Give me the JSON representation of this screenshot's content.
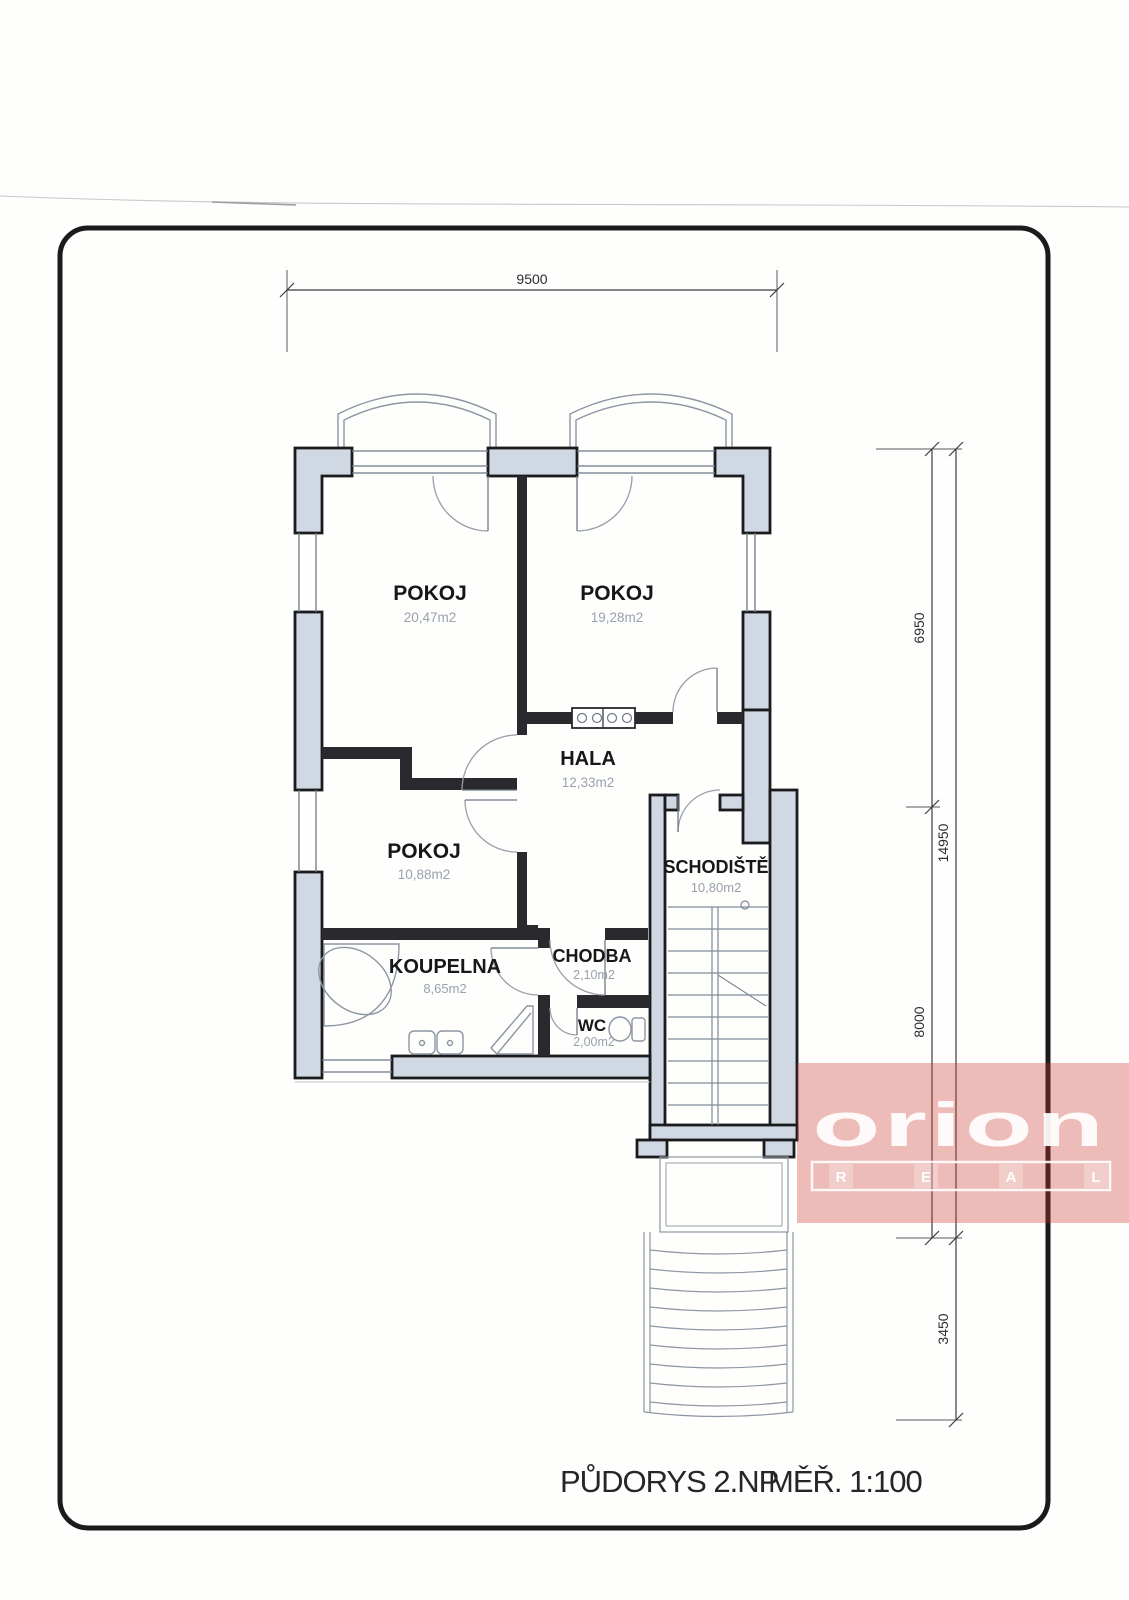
{
  "title": {
    "main": "PŮDORYS 2.NP",
    "scale": "MĚŘ. 1:100"
  },
  "dimensions": {
    "top": "9500",
    "right_upper": "6950",
    "right_lower": "8000",
    "right_total": "14950",
    "right_entry_stairs": "3450"
  },
  "rooms": {
    "pokoj_top_left": {
      "name": "POKOJ",
      "area": "20,47m2"
    },
    "pokoj_top_right": {
      "name": "POKOJ",
      "area": "19,28m2"
    },
    "pokoj_small": {
      "name": "POKOJ",
      "area": "10,88m2"
    },
    "hala": {
      "name": "HALA",
      "area": "12,33m2"
    },
    "schodiste": {
      "name": "SCHODIŠTĚ",
      "area": "10,80m2"
    },
    "koupelna": {
      "name": "KOUPELNA",
      "area": "8,65m2"
    },
    "chodba": {
      "name": "CHODBA",
      "area": "2,10m2"
    },
    "wc": {
      "name": "WC",
      "area": "2,00m2"
    }
  },
  "watermark": {
    "brand": "orion",
    "letters": [
      "R",
      "E",
      "A",
      "L"
    ],
    "overlay_color": "#e06a5f"
  },
  "colors": {
    "wall_fill": "#cfd8e3",
    "line": "#1b1b1e"
  }
}
